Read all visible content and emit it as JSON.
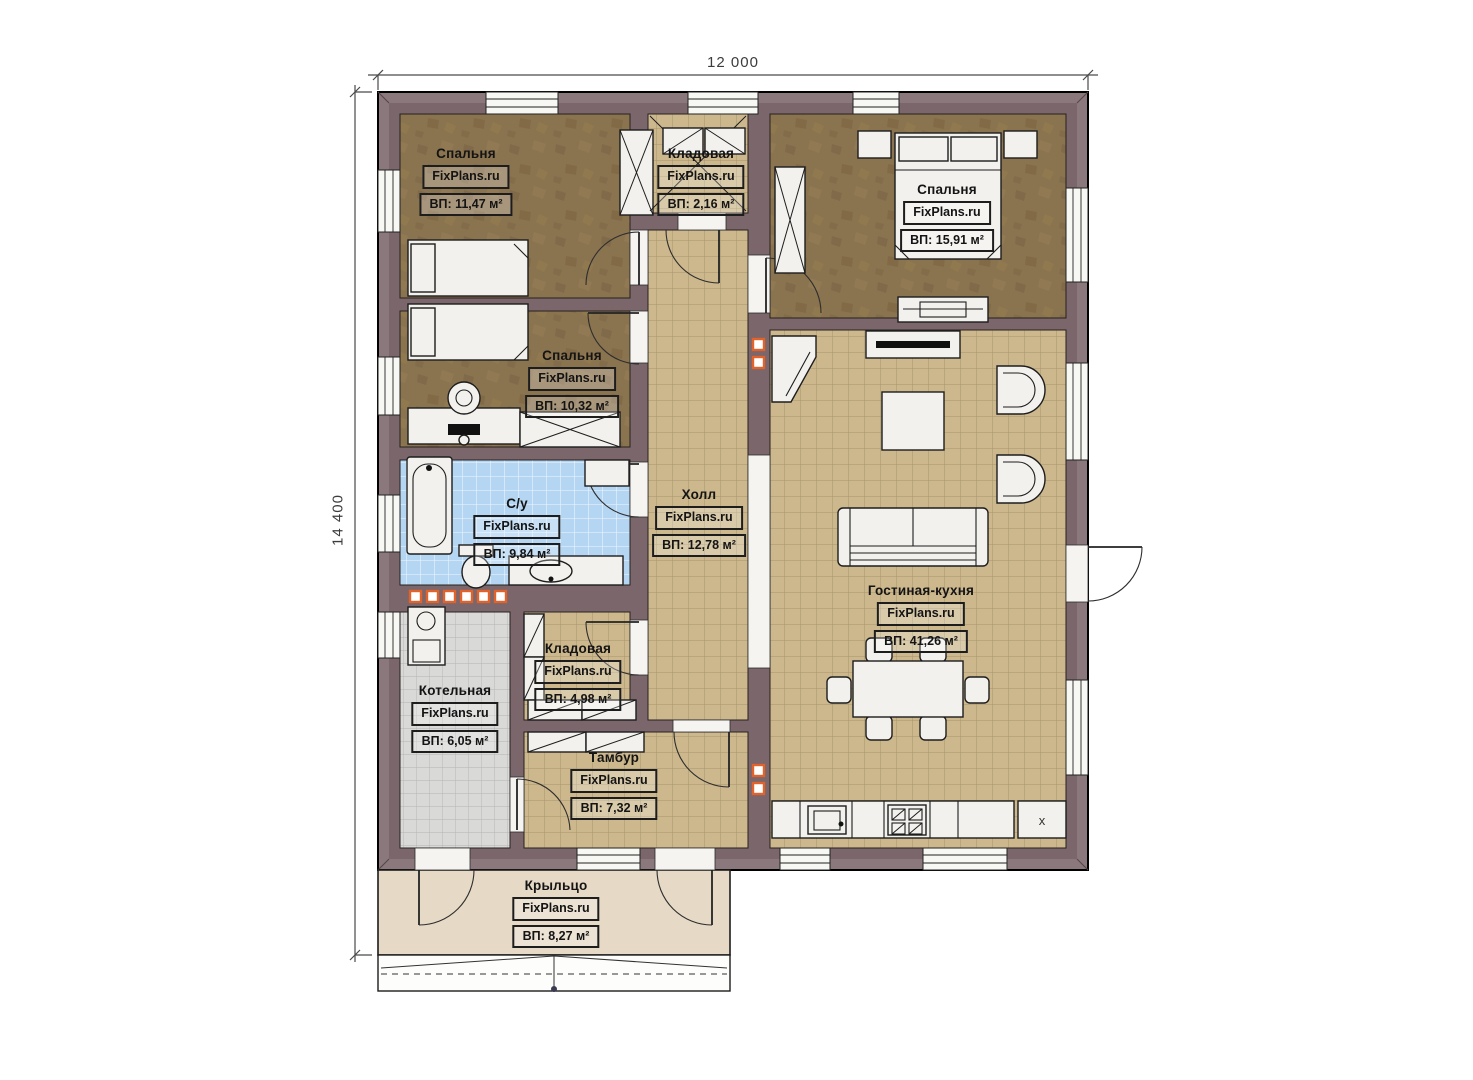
{
  "watermark": "FixPlans.ru",
  "dimensions": {
    "width": "12 000",
    "depth": "14 400"
  },
  "kitchen": {
    "marker": "x"
  },
  "rooms": {
    "bedroom1": {
      "name": "Спальня",
      "area": "ВП: 11,47 м²"
    },
    "storage_top": {
      "name": "Кладовая",
      "area": "ВП: 2,16 м²"
    },
    "bedroom3": {
      "name": "Спальня",
      "area": "ВП: 15,91 м²"
    },
    "bedroom2": {
      "name": "Спальня",
      "area": "ВП: 10,32 м²"
    },
    "bathroom": {
      "name": "С/у",
      "area": "ВП: 9,84 м²"
    },
    "hall": {
      "name": "Холл",
      "area": "ВП: 12,78 м²"
    },
    "living_kitchen": {
      "name": "Гостиная-кухня",
      "area": "ВП: 41,26 м²"
    },
    "storage2": {
      "name": "Кладовая",
      "area": "ВП: 4,98 м²"
    },
    "boiler": {
      "name": "Котельная",
      "area": "ВП: 6,05 м²"
    },
    "tambour": {
      "name": "Тамбур",
      "area": "ВП: 7,32 м²"
    },
    "porch": {
      "name": "Крыльцо",
      "area": "ВП: 8,27 м²"
    }
  },
  "colors": {
    "wall": "#7a666b",
    "wall_light": "#8b787c",
    "floor_wood": "#8a734f",
    "tile_tan": "#cdb88e",
    "tile_blue": "#b5d6f2",
    "tile_gray": "#d9d9d7",
    "porch": "#e6dac6",
    "accent_orange": "#e2622b"
  }
}
